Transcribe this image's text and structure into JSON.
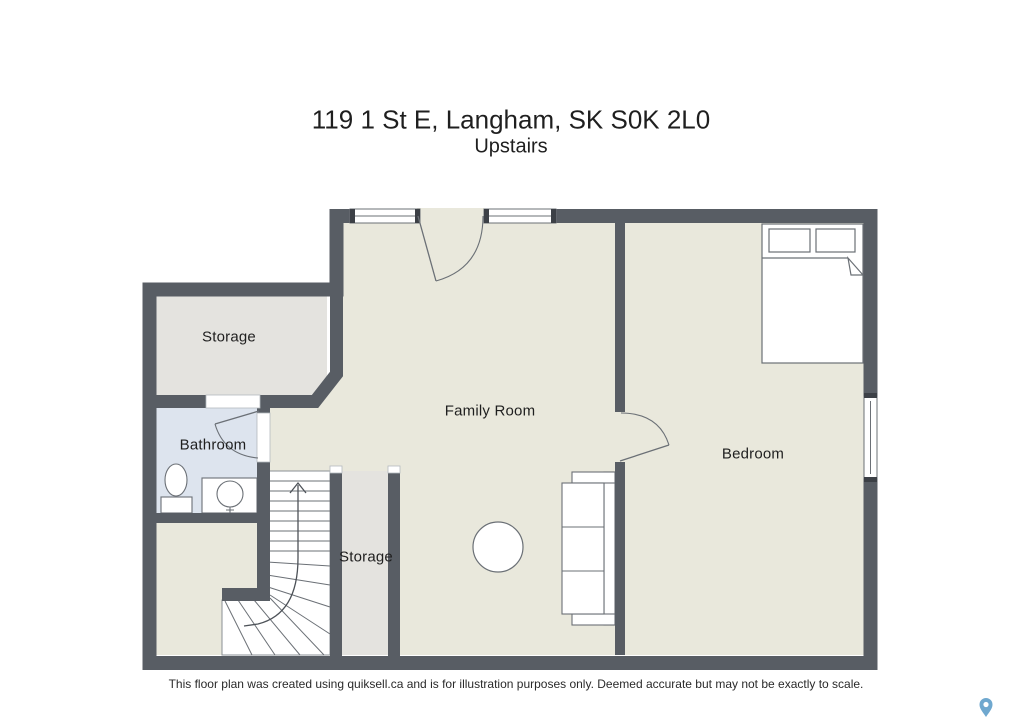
{
  "title": {
    "address": "119 1 St E, Langham, SK S0K 2L0",
    "floor": "Upstairs"
  },
  "rooms": {
    "storage_upper": "Storage",
    "bathroom": "Bathroom",
    "family_room": "Family Room",
    "bedroom": "Bedroom",
    "storage_stairs": "Storage"
  },
  "stairs": {
    "direction": "up"
  },
  "footer": {
    "disclaimer": "This floor plan was created using quiksell.ca and is for illustration purposes only. Deemed accurate but may not be exactly to scale."
  },
  "colors": {
    "wall": "#585d64",
    "floor": "#e9e8dc",
    "storage": "#e4e3df",
    "bathroom": "#dde4ee",
    "fixture": "#6b7076",
    "text": "#1f1f1f",
    "pin": "#6fa8cf",
    "threshold": "#b4b9be"
  }
}
